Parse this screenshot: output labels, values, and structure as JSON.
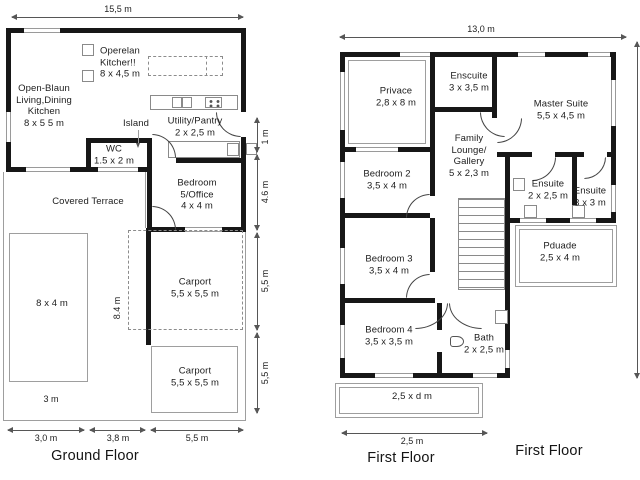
{
  "colors": {
    "wall": "#171717",
    "thin_line": "#9e9e9e",
    "dimension_line": "#565656",
    "text": "#1d1d1d",
    "background": "#ffffff"
  },
  "ground_floor": {
    "title": "Ground Floor",
    "dims": {
      "top": "15,5 m",
      "right_1": "1 m",
      "right_2": "4.6 m",
      "right_3": "5,5 m",
      "right_4": "5,5 m",
      "bottom_1": "3,0 m",
      "bottom_2": "3,8 m",
      "bottom_3": "5,5 m",
      "carport_depth": "8.4 m",
      "terrace_width": "3 m"
    },
    "rooms": {
      "kitchen_note": "Operelan\nKitcher!!\n8 x 4,5 m",
      "living": "Open-Blaun\nLiving,Dining\nKitchen\n8 x 5 5 m",
      "island": "Island",
      "utility": "Utility/Pantry\n2 x 2,5 m",
      "wc": "WC\n1.5 x 2 m",
      "terrace": "Covered Terrace",
      "bedroom5": "Bedroom\n5/Office\n4 x 4 m",
      "pool": "8 x 4 m",
      "carport1": "Carport\n5,5 x 5,5 m",
      "carport2": "Carport\n5,5 x 5,5 m"
    }
  },
  "first_floor": {
    "title": "First Floor",
    "side_title": "First Floor",
    "dims": {
      "top": "13,0 m",
      "bottom": "2,5 m"
    },
    "rooms": {
      "privace": "Privace\n2,8 x 8 m",
      "ensuite_top": "Enscuite\n3 x 3,5 m",
      "master": "Master Suite\n5,5 x 4,5 m",
      "family": "Family\nLounge/\nGallery\n5 x 2,3 m",
      "bedroom2": "Bedroom 2\n3,5 x 4 m",
      "ensuite_mid": "Ensuite\n2 x 2,5 m",
      "ensuite_right": "Ensuite\n3 x 3 m",
      "pduade": "Pduade\n2,5 x 4 m",
      "bedroom3": "Bedroom 3\n3,5 x 4 m",
      "bedroom4": "Bedroom 4\n3,5 x 3,5 m",
      "bath": "Bath\n2 x 2,5 m",
      "balcony": "2,5 x d m"
    }
  }
}
